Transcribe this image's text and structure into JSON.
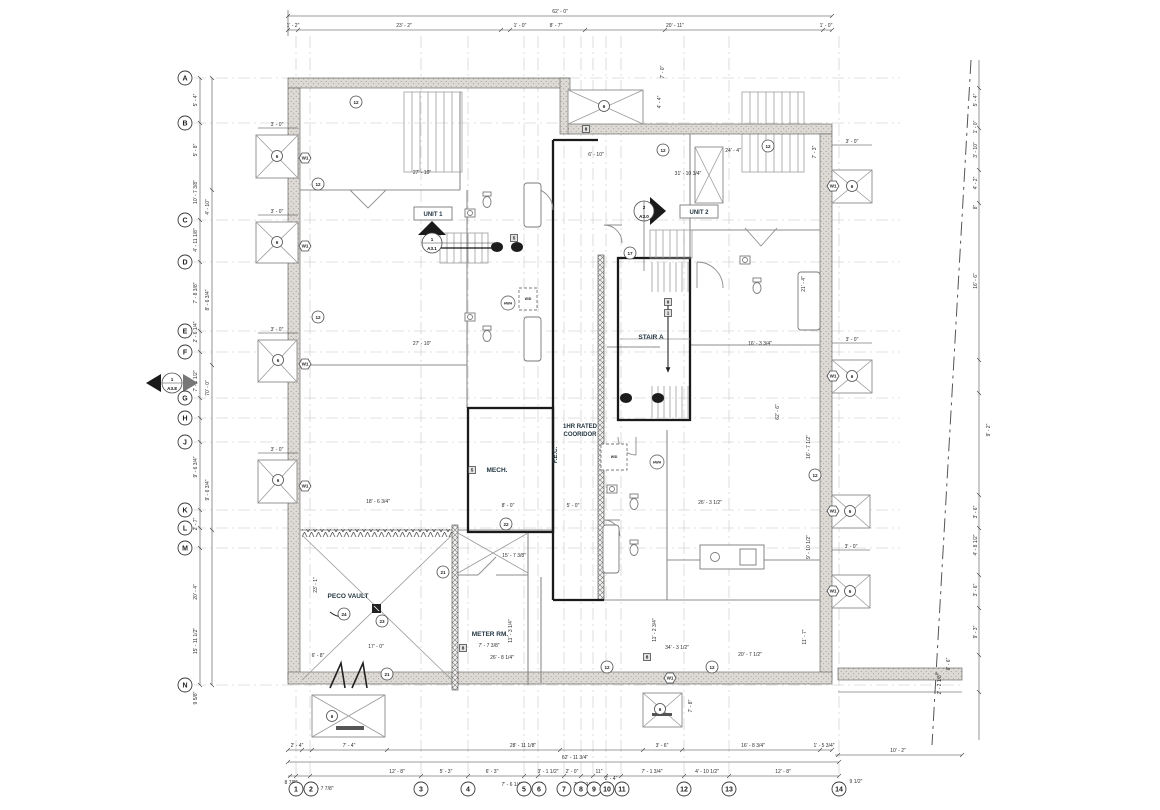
{
  "sheet": {
    "title": "first-floor-plan",
    "bg": "#ffffff",
    "accent": "#243743"
  },
  "grid": {
    "rows": [
      "A",
      "B",
      "C",
      "D",
      "E",
      "F",
      "G",
      "H",
      "J",
      "K",
      "L",
      "M",
      "N"
    ],
    "cols": [
      "1",
      "2",
      "3",
      "4",
      "5",
      "6",
      "7",
      "8",
      "9",
      "10",
      "11",
      "12",
      "13",
      "14"
    ]
  },
  "rooms": {
    "unit1": "UNIT 1",
    "unit2": "UNIT 2",
    "stair_a": "STAIR A",
    "mech": "MECH.",
    "peco_vault": "PECO VAULT",
    "meter_rm": "METER RM.",
    "corridor_line1": "1HR RATED",
    "corridor_line2": "COORIDOR",
    "fec": "F.E.C."
  },
  "equipment": {
    "hwh": "HWH",
    "wd": "W/D"
  },
  "markers": {
    "a31_num": "1",
    "a31_sheet": "A3.1",
    "a30_num": "2",
    "a30_sheet": "A3.0",
    "a38_num": "1",
    "a38_sheet": "A3.8"
  },
  "tags": {
    "t6": "6",
    "t12": "12",
    "t17": "17",
    "t21": "21",
    "t22": "22",
    "t23": "23",
    "t24": "24",
    "w1": "W1",
    "k1": "1",
    "k5": "5",
    "k8": "8",
    "k9": "9"
  },
  "dims": {
    "top_overall": "62' - 0\"",
    "top": [
      "1' - 2\"",
      "23' - 2\"",
      "1' - 0\"",
      "8' - 7\"",
      "20' - 11\"",
      "1' - 0\""
    ],
    "bottom_overall": "62' - 11 3/4\"",
    "bottom_row1": [
      "2' - 4\"",
      "7' - 4\"",
      "28' - 11 1/8\"",
      "3' - 6\"",
      "16' - 8 3/4\"",
      "1' - 5 3/4\"",
      "10' - 2\""
    ],
    "bottom_row2": [
      "8 7/8\"",
      "1' - 7 7/8\"",
      "12' - 8\"",
      "5' - 3\"",
      "6' - 3\"",
      "7' - 6 1/4\"",
      "3' - 1 1/2\"",
      "2' - 0\"",
      "7' - 4 1/2\"",
      "11\"",
      "2' - 4\"",
      "7' - 1 3/4\"",
      "4' - 10 1/2\"",
      "12' - 8\"",
      "9 1/2\""
    ],
    "left": [
      "5' - 4\"",
      "5' - 8\"",
      "10' - 7 3/8\"",
      "4' - 11 1/8\"",
      "7' - 8 3/8\"",
      "2' - 6 1/4\"",
      "7' - 1 1/2\"",
      "9' - 6 3/4\"",
      "2' - 7\"",
      "20' - 4\"",
      "15' - 11 1/2\"",
      "9 5/8\"",
      "4' - 10\"",
      "8' - 6 3/4\"",
      "70' - 0\"",
      "9' - 6 3/4\""
    ],
    "right": [
      "5' - 4\"",
      "1' - 0\"",
      "3' - 10\"",
      "4' - 2\"",
      "8\"",
      "16' - 6\"",
      "3' - 6\"",
      "4' - 8 1/2\"",
      "3' - 6\"",
      "9' - 3\"",
      "6' - 6\"",
      "2' - 2 1/8\"",
      "9' - 2\""
    ],
    "interior": [
      "27' - 10\"",
      "27' - 10\"",
      "31' - 10 3/4\"",
      "24' - 4\"",
      "6' - 10\"",
      "7' - 0\"",
      "4' - 4\"",
      "7' - 3\"",
      "16' - 3 3/4\"",
      "21' - 4\"",
      "23' - 1\"",
      "17' - 0\"",
      "6' - 8\"",
      "15' - 7 3/8\"",
      "7' - 7 3/8\"",
      "26' - 8 1/4\"",
      "11' - 3 1/4\"",
      "8' - 0\"",
      "5' - 0\"",
      "26' - 3 1/2\"",
      "62' - 6\"",
      "16' - 7 1/2\"",
      "9' - 10 1/2\"",
      "34' - 3 1/2\"",
      "20' - 7 1/2\"",
      "11' - 2 3/4\"",
      "11' - 7\"",
      "7' - 8\"",
      "18' - 6 3/4\"",
      "3' - 0\"",
      "3' - 0\"",
      "3' - 0\"",
      "3' - 0\"",
      "3' - 0\"",
      "3' - 0\"",
      "3' - 0\""
    ]
  }
}
